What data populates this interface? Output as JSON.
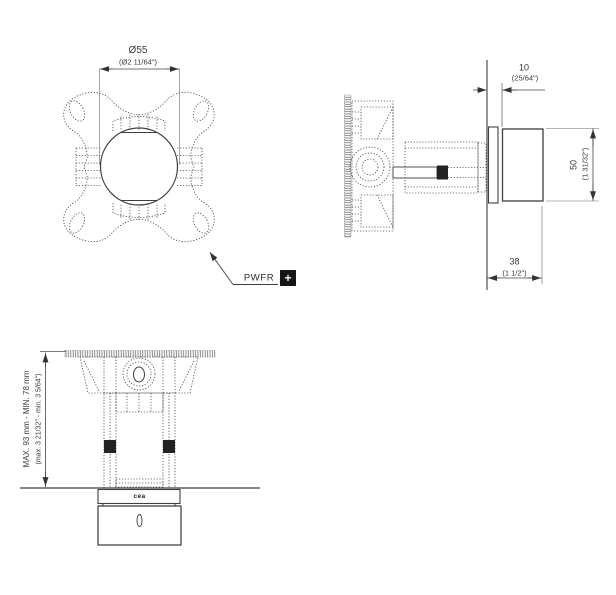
{
  "labels": {
    "front_dia_mm": "Ø55",
    "front_dia_in": "(Ø2 11/64\")",
    "side_offset_mm": "10",
    "side_offset_in": "(25/64\")",
    "side_height_mm": "50",
    "side_height_in": "(1 31/32\")",
    "side_depth_mm": "38",
    "side_depth_in": "(1 1/2\")",
    "top_range_mm": "MAX. 93 mm - MIN. 78 mm",
    "top_range_in": "(max. 3 21/32\" - min. 3 5/64\")",
    "callout_label": "PWFR",
    "callout_plus": "+",
    "brand": "cea"
  },
  "colors": {
    "line": "#4a4a4a",
    "solid_line": "#3f3f3f",
    "text": "#3a3a3a",
    "accent_black": "#1a1a1a",
    "background": "#ffffff"
  }
}
